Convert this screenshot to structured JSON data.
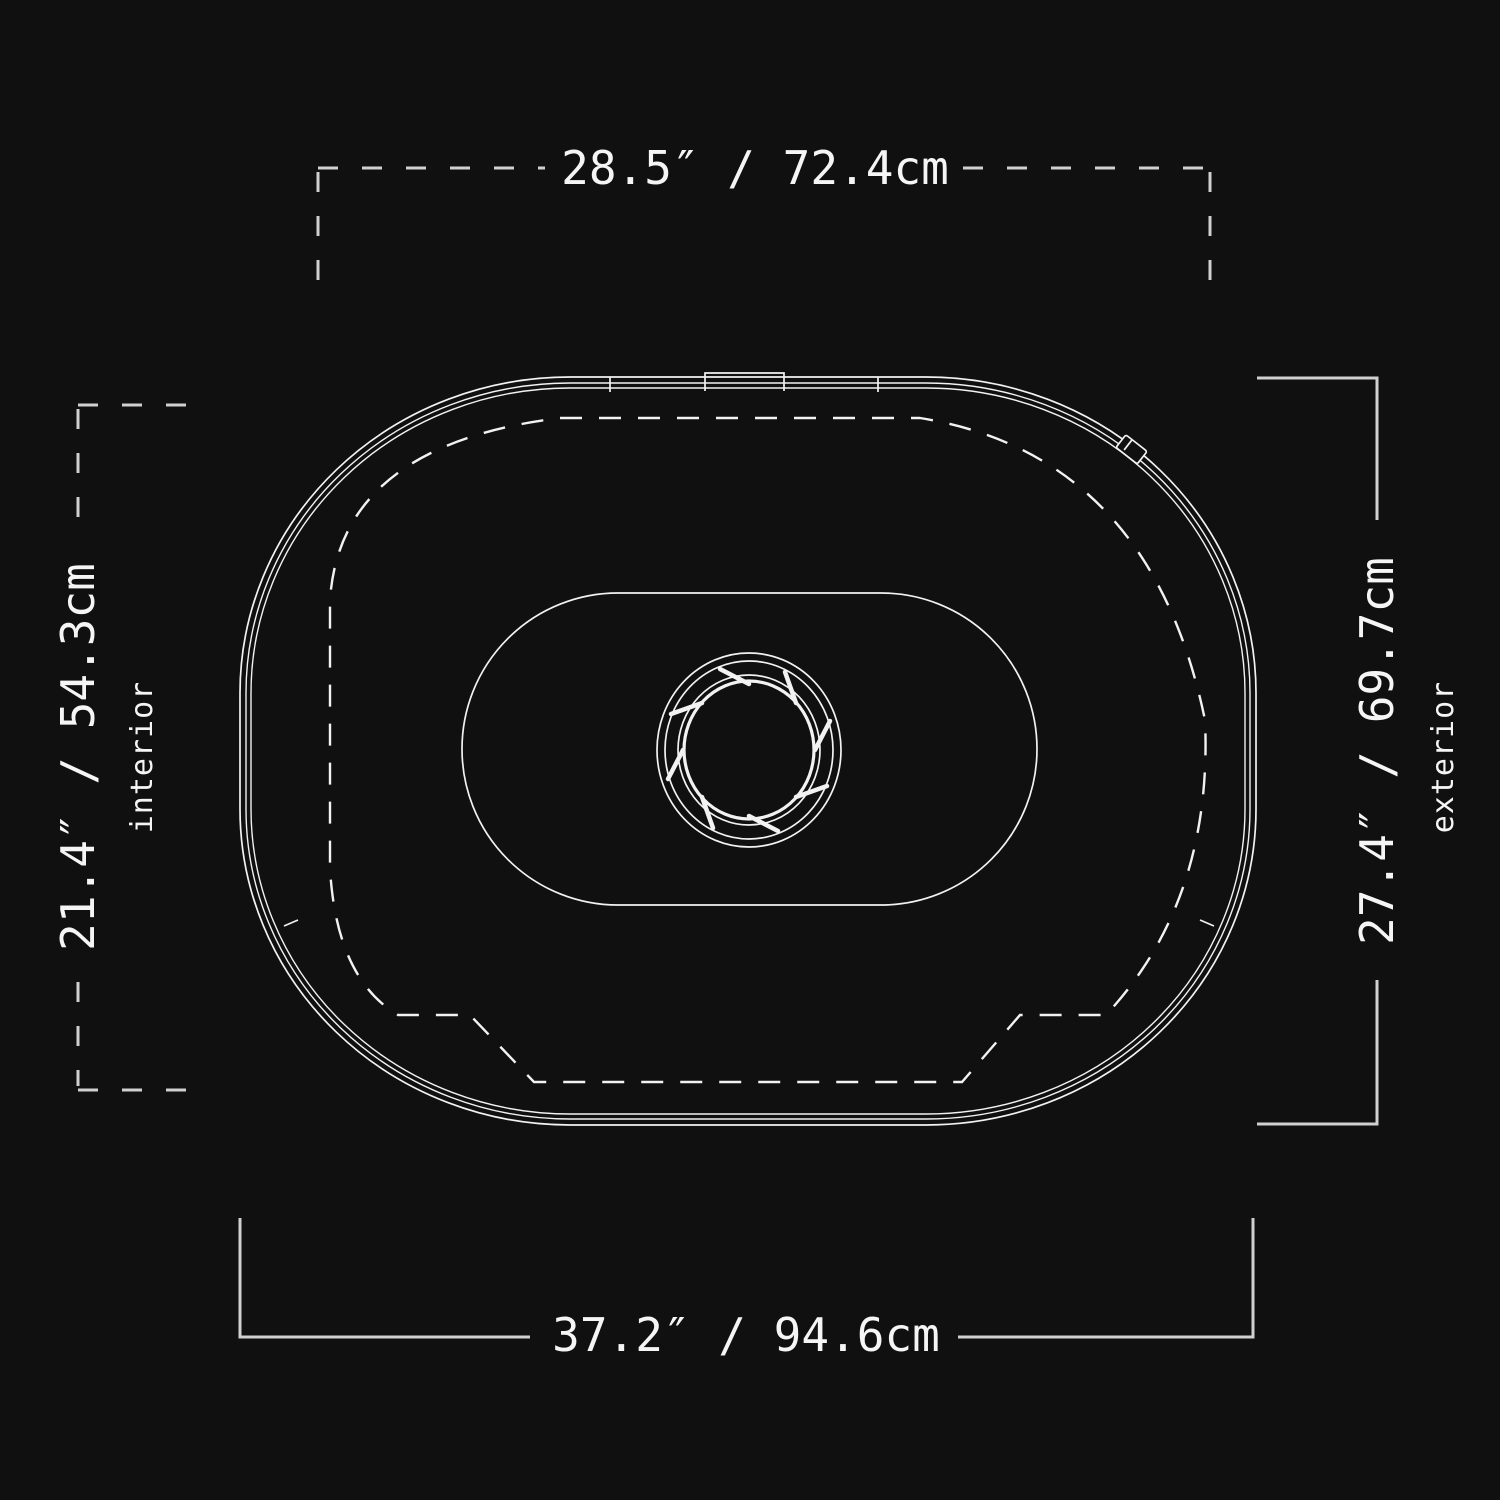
{
  "page": {
    "title": "Product top-view dimension diagram",
    "view": "top"
  },
  "colors": {
    "background": "#101010",
    "drawing_line": "#f2f2f2",
    "dimension_line": "#d0d0d0",
    "label_text": "#f5f5f5"
  },
  "dimensions": {
    "top_width": {
      "label": "28.5″ / 72.4cm",
      "inches": "28.5″",
      "centimeters": "72.4cm",
      "line_style": "dashed"
    },
    "left_height": {
      "label": "21.4″ / 54.3cm",
      "sublabel": "interior",
      "inches": "21.4″",
      "centimeters": "54.3cm",
      "line_style": "dashed"
    },
    "right_height": {
      "label": "27.4″ / 69.7cm",
      "sublabel": "exterior",
      "inches": "27.4″",
      "centimeters": "69.7cm",
      "line_style": "solid"
    },
    "bottom_width": {
      "label": "37.2″ / 94.6cm",
      "inches": "37.2″",
      "centimeters": "94.6cm",
      "line_style": "solid"
    }
  }
}
